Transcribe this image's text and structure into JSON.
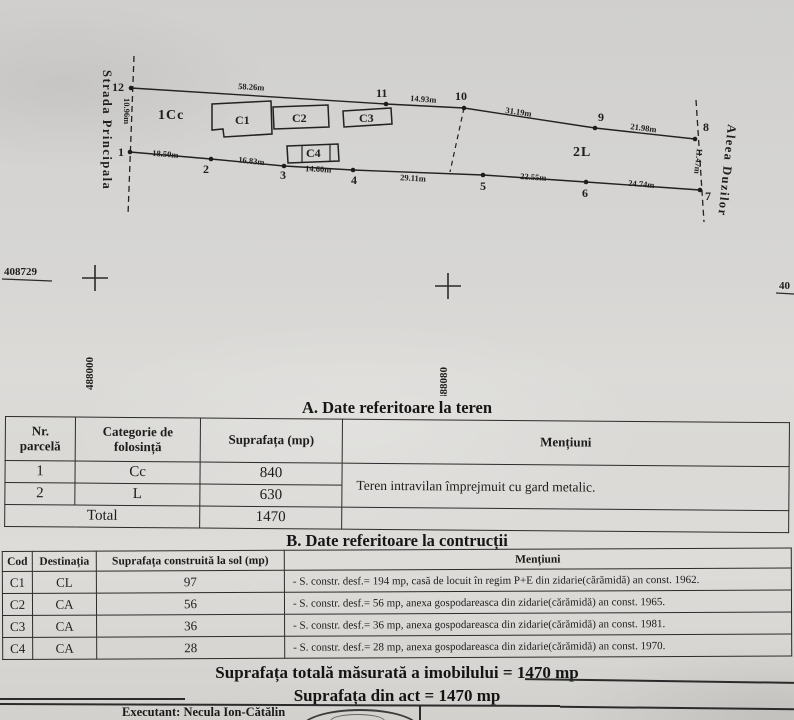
{
  "plan": {
    "street_left": "Strada Principala",
    "street_right": "Aleea Duzilor",
    "zone1": "1Cc",
    "zone2": "2L",
    "buildings": {
      "c1": "C1",
      "c2": "C2",
      "c3": "C3",
      "c4": "C4"
    },
    "points": {
      "p1": "1",
      "p2": "2",
      "p3": "3",
      "p4": "4",
      "p5": "5",
      "p6": "6",
      "p7": "7",
      "p8": "8",
      "p9": "9",
      "p10": "10",
      "p11": "11",
      "p12": "12"
    },
    "measurements": {
      "left": "10.96m",
      "top1": "58.26m",
      "top2": "14.93m",
      "top3": "31.19m",
      "top4": "21.98m",
      "right": "11.47m",
      "bottom1": "18.50m",
      "bottom2": "16.83m",
      "bottom3": "14.60m",
      "bottom4": "29.11m",
      "bottom5": "22.55m",
      "bottom6": "24.74m"
    },
    "grid": {
      "code_left": "408729",
      "coord_left": "488000",
      "coord_mid": "488080",
      "coord_right_partial": "40"
    }
  },
  "table_a": {
    "title": "A. Date referitoare la teren",
    "headers": {
      "nr": "Nr.\nparcelă",
      "categorie": "Categorie de\nfolosință",
      "suprafata": "Suprafața (mp)",
      "mentiuni": "Mențiuni"
    },
    "rows": [
      {
        "nr": "1",
        "cat": "Cc",
        "sup": "840"
      },
      {
        "nr": "2",
        "cat": "L",
        "sup": "630"
      }
    ],
    "mentiuni_text": "Teren intravilan împrejmuit cu gard metalic.",
    "total_label": "Total",
    "total_value": "1470"
  },
  "table_b": {
    "title": "B. Date referitoare la contrucții",
    "headers": {
      "cod": "Cod",
      "dest": "Destinația",
      "suprafata": "Suprafața construită la sol (mp)",
      "mentiuni": "Mențiuni"
    },
    "rows": [
      {
        "cod": "C1",
        "dest": "CL",
        "sup": "97",
        "mentiuni": "- S. constr. desf.= 194 mp, casă de locuit în regim P+E din zidarie(cărămidă) an const. 1962."
      },
      {
        "cod": "C2",
        "dest": "CA",
        "sup": "56",
        "mentiuni": "- S. constr. desf.= 56 mp, anexa gospodareasca din zidarie(cărămidă) an const. 1965."
      },
      {
        "cod": "C3",
        "dest": "CA",
        "sup": "36",
        "mentiuni": "- S. constr. desf.= 36 mp, anexa gospodareasca din zidarie(cărămidă) an const. 1981."
      },
      {
        "cod": "C4",
        "dest": "CA",
        "sup": "28",
        "mentiuni": "- S. constr. desf.= 28 mp, anexa gospodareasca din zidarie(cărămidă) an const. 1970."
      }
    ]
  },
  "footer": {
    "total_measured": "Suprafața totală măsurată a imobilului = 1470 mp",
    "total_act": "Suprafața din act = 1470 mp",
    "executant": "Executant: Necula Ion-Cătălin"
  },
  "colors": {
    "paper": "#d4d3d1",
    "ink": "#1d1d1d"
  }
}
